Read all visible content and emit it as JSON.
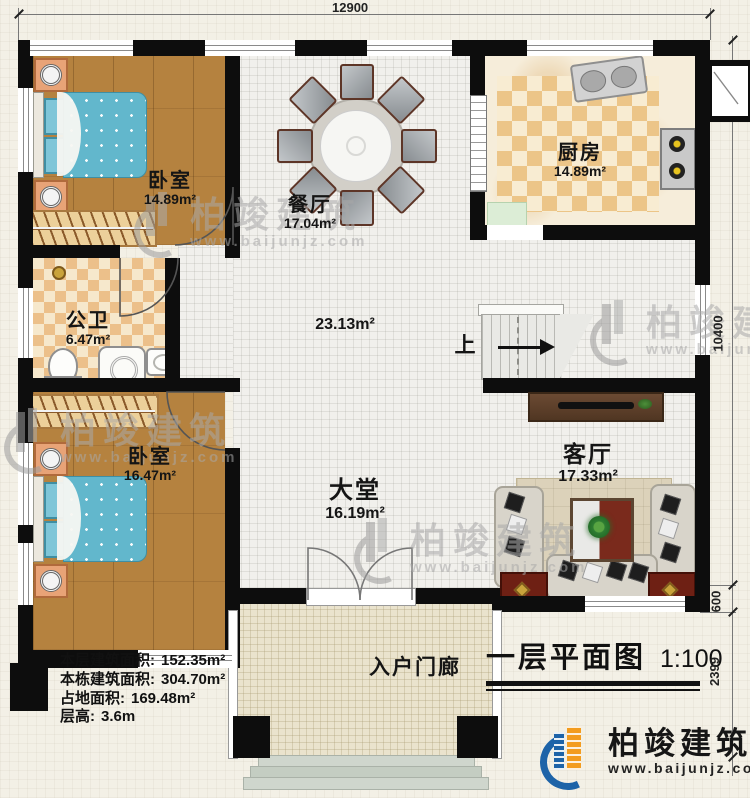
{
  "plan": {
    "sheet_title": "一层平面图",
    "scale": "1:100",
    "dims": {
      "top": "12900",
      "right_main": "10400",
      "right_step": "600",
      "right_porch": "2399"
    },
    "rooms": {
      "bedroom1": {
        "name": "卧室",
        "area": "14.89m²"
      },
      "dining": {
        "name": "餐厅",
        "area": "17.04m²"
      },
      "kitchen": {
        "name": "厨房",
        "area": "14.89m²"
      },
      "bath": {
        "name": "公卫",
        "area": "6.47m²"
      },
      "hall": {
        "area": "23.13m²"
      },
      "bedroom2": {
        "name": "卧室",
        "area": "16.47m²"
      },
      "lobby": {
        "name": "大堂",
        "area": "16.19m²"
      },
      "living": {
        "name": "客厅",
        "area": "17.33m²"
      },
      "porch": {
        "name": "入户门廊"
      },
      "stairs": {
        "up_label": "上"
      }
    },
    "stats": {
      "lines": [
        {
          "label": "本层建筑面积:",
          "value": "152.35m²"
        },
        {
          "label": "本栋建筑面积:",
          "value": "304.70m²"
        },
        {
          "label": "占地面积:",
          "value": "169.48m²"
        },
        {
          "label": "层高:",
          "value": "3.6m"
        }
      ]
    },
    "brand": {
      "name": "柏竣建筑",
      "url": "www.baijunjz.com"
    },
    "colors": {
      "wall": "#0d0d0d",
      "wood": "#b5823f",
      "blanket": "#62b7cc",
      "logo_blue": "#1d63a8",
      "logo_orange": "#f39c1f",
      "end_table_red": "#6e2014"
    }
  }
}
